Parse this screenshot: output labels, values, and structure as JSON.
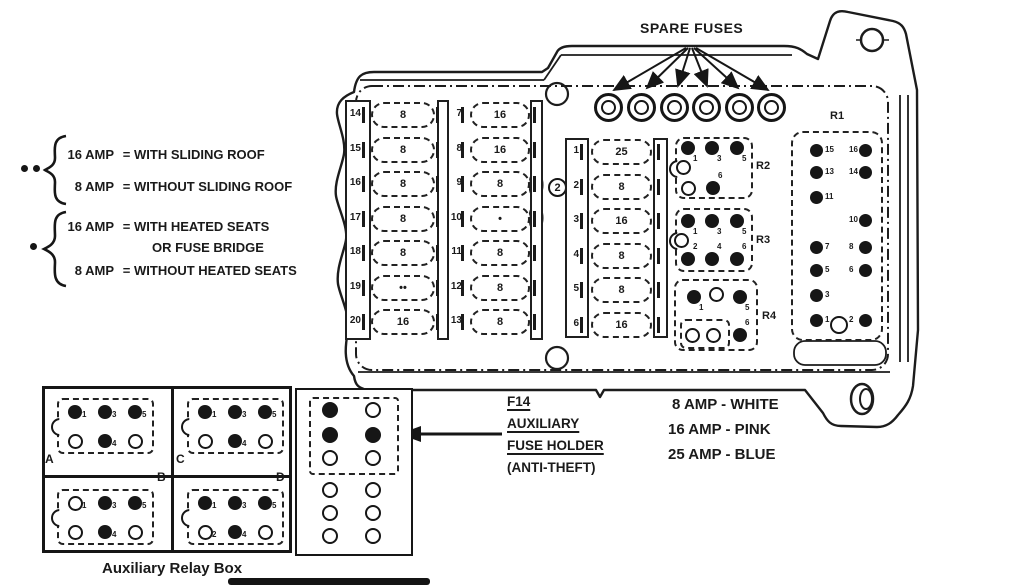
{
  "spare_fuses": {
    "label": "SPARE FUSES",
    "count": 6
  },
  "callouts": {
    "circled_2": "2"
  },
  "amp_legend": {
    "group1": {
      "rows": [
        {
          "amp": "16 AMP",
          "eq": "=",
          "desc": "WITH SLIDING ROOF"
        },
        {
          "amp": "8 AMP",
          "eq": "=",
          "desc": "WITHOUT SLIDING ROOF"
        }
      ]
    },
    "group2": {
      "rows": [
        {
          "amp": "16 AMP",
          "eq": "=",
          "desc": "WITH HEATED SEATS"
        },
        {
          "desc2": "OR FUSE BRIDGE"
        },
        {
          "amp": "8 AMP",
          "eq": "=",
          "desc": "WITHOUT HEATED SEATS"
        }
      ]
    }
  },
  "fuse_columns": [
    {
      "rows": [
        [
          "14",
          "8"
        ],
        [
          "15",
          "8"
        ],
        [
          "16",
          "8"
        ],
        [
          "17",
          "8"
        ],
        [
          "18",
          "8"
        ],
        [
          "19",
          "••"
        ],
        [
          "20",
          "16"
        ]
      ]
    },
    {
      "rows": [
        [
          "7",
          "16"
        ],
        [
          "8",
          "16"
        ],
        [
          "9",
          "8"
        ],
        [
          "10",
          "•"
        ],
        [
          "11",
          "8"
        ],
        [
          "12",
          "8"
        ],
        [
          "13",
          "8"
        ]
      ]
    },
    {
      "rows": [
        [
          "1",
          "25"
        ],
        [
          "2",
          "8"
        ],
        [
          "3",
          "16"
        ],
        [
          "4",
          "8"
        ],
        [
          "5",
          "8"
        ],
        [
          "6",
          "16"
        ]
      ]
    }
  ],
  "relays": {
    "r1": {
      "label": "R1",
      "rows": [
        [
          "15",
          "16"
        ],
        [
          "13",
          "14"
        ],
        [
          "11",
          ""
        ],
        [
          "",
          "10"
        ],
        [
          "7",
          "8"
        ],
        [
          "5",
          "6"
        ],
        [
          "3",
          ""
        ],
        [
          "1",
          "2"
        ]
      ],
      "bottom_open_circle": true
    },
    "r2": {
      "label": "R2",
      "pins": [
        {
          "f": 1,
          "n": "1"
        },
        {
          "f": 1,
          "n": "3"
        },
        {
          "f": 1,
          "n": "5"
        },
        {
          "f": 0,
          "n": ""
        },
        {
          "f": 0,
          "n": ""
        },
        {
          "f": 1,
          "n": "6"
        }
      ]
    },
    "r3": {
      "label": "R3",
      "pins": [
        {
          "f": 1,
          "n": "1"
        },
        {
          "f": 1,
          "n": "3"
        },
        {
          "f": 1,
          "n": "5"
        },
        {
          "f": 0,
          "n": ""
        },
        {
          "f": 1,
          "n": "2"
        },
        {
          "f": 1,
          "n": "4"
        },
        {
          "f": 1,
          "n": "6"
        }
      ]
    },
    "r4": {
      "label": "R4",
      "pins": [
        {
          "f": 1,
          "n": "1"
        },
        {
          "f": 0,
          "n": ""
        },
        {
          "f": 1,
          "n": "5"
        },
        {
          "f": 0,
          "n": ""
        },
        {
          "f": 0,
          "n": ""
        },
        {
          "f": 1,
          "n": "6"
        }
      ]
    }
  },
  "aux_relay_box": {
    "caption": "Auxiliary Relay Box",
    "sockets": [
      {
        "label": "A",
        "pins": [
          {
            "f": 1,
            "n": "1"
          },
          {
            "f": 1,
            "n": "3"
          },
          {
            "f": 1,
            "n": "5"
          },
          {
            "f": 0,
            "n": ""
          },
          {
            "f": 1,
            "n": "4"
          },
          {
            "f": 0,
            "n": ""
          }
        ]
      },
      {
        "label": "C",
        "pins": [
          {
            "f": 1,
            "n": "1"
          },
          {
            "f": 1,
            "n": "3"
          },
          {
            "f": 1,
            "n": "5"
          },
          {
            "f": 0,
            "n": ""
          },
          {
            "f": 1,
            "n": "4"
          },
          {
            "f": 0,
            "n": ""
          }
        ]
      },
      {
        "label": "B",
        "pins": [
          {
            "f": 0,
            "n": "1"
          },
          {
            "f": 1,
            "n": "3"
          },
          {
            "f": 1,
            "n": "5"
          },
          {
            "f": 0,
            "n": ""
          },
          {
            "f": 1,
            "n": "4"
          },
          {
            "f": 0,
            "n": ""
          }
        ]
      },
      {
        "label": "D",
        "pins": [
          {
            "f": 1,
            "n": "1"
          },
          {
            "f": 1,
            "n": "3"
          },
          {
            "f": 1,
            "n": "5"
          },
          {
            "f": 0,
            "n": "2"
          },
          {
            "f": 1,
            "n": "4"
          },
          {
            "f": 0,
            "n": ""
          }
        ]
      }
    ]
  },
  "aux_fuse_holder": {
    "lines": [
      "F14",
      "AUXILIARY",
      "FUSE HOLDER",
      "(ANTI-THEFT)"
    ],
    "pin_rows": [
      [
        1,
        0
      ],
      [
        1,
        1
      ],
      [
        0,
        0
      ],
      [
        0,
        0
      ],
      [
        0,
        0
      ],
      [
        0,
        0
      ]
    ]
  },
  "color_code": {
    "lines": [
      "8 AMP - WHITE",
      "16 AMP - PINK",
      "25 AMP - BLUE"
    ]
  }
}
